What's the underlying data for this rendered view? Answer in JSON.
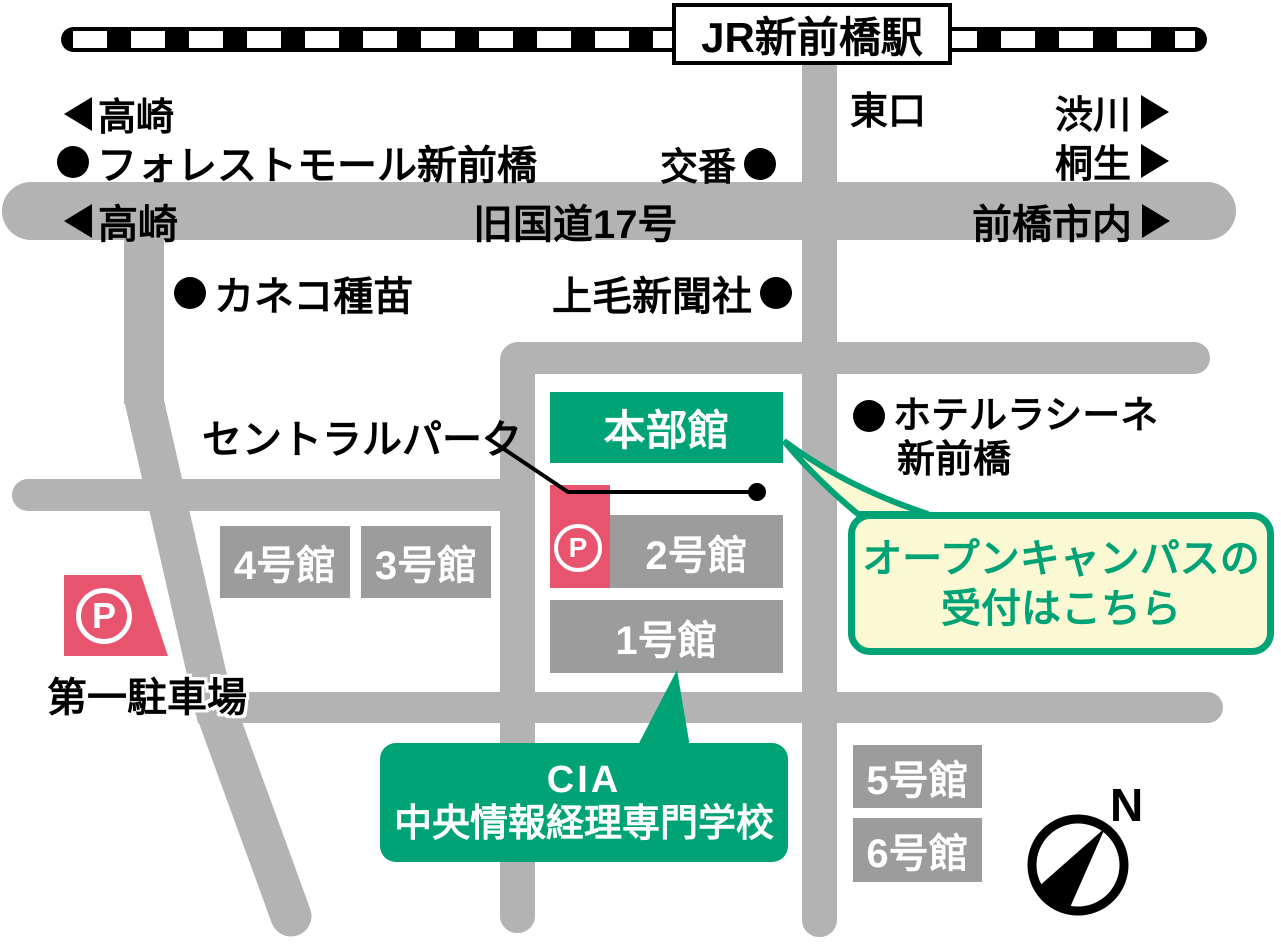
{
  "station": {
    "name": "JR新前橋駅"
  },
  "directions": {
    "takasaki": "高崎",
    "shibukawa": "渋川",
    "kiryu": "桐生",
    "east_exit": "東口",
    "maebashi_city": "前橋市内"
  },
  "roads": {
    "route17": "旧国道17号"
  },
  "landmarks": {
    "forest_mall": "フォレストモール新前橋",
    "koban": "交番",
    "kaneko": "カネコ種苗",
    "jomo": "上毛新聞社",
    "central_park": "セントラルパーク",
    "hotel_line1": "ホテルラシーネ",
    "hotel_line2": "新前橋"
  },
  "buildings": {
    "honbu": "本部館",
    "b1": "1号館",
    "b2": "2号館",
    "b3": "3号館",
    "b4": "4号館",
    "b5": "5号館",
    "b6": "6号館"
  },
  "parking": {
    "p_label": "P",
    "daiichi": "第一駐車場"
  },
  "callout": {
    "line1": "オープンキャンパスの",
    "line2": "受付はこちら"
  },
  "school": {
    "abbr": "CIA",
    "name": "中央情報経理専門学校"
  },
  "compass": {
    "north": "N"
  },
  "colors": {
    "green": "#00a376",
    "pink": "#e8546e",
    "callout_yellow": "#fbf9d3",
    "road_gray": "#b3b3b3",
    "building_gray": "#9c9c9c",
    "railway_black": "#000000"
  }
}
